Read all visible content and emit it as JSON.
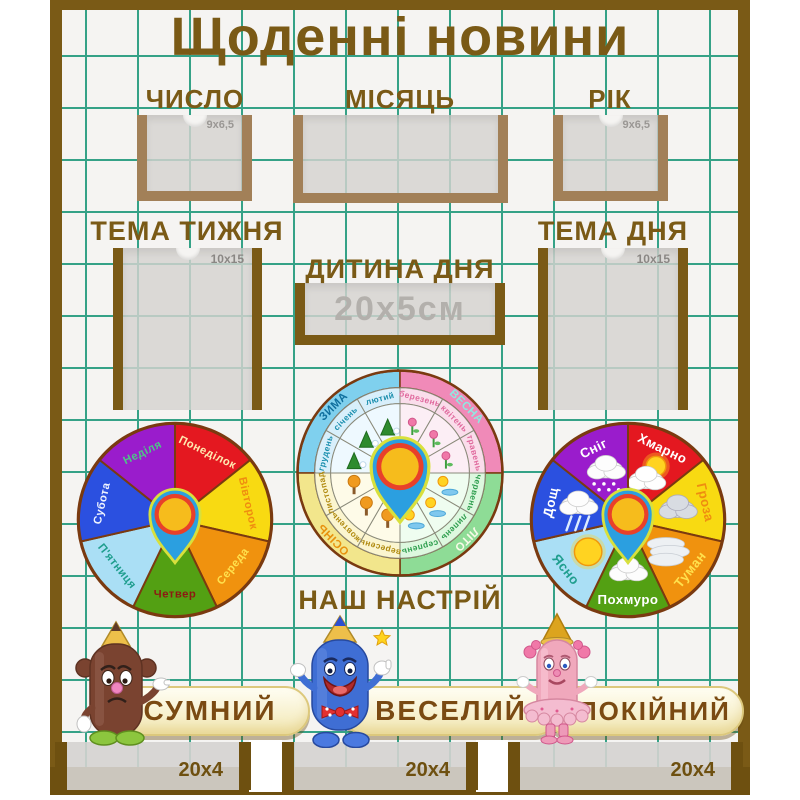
{
  "title": "Щоденні новини",
  "sections": {
    "date": {
      "label": "ЧИСЛО",
      "size": "9x6,5"
    },
    "month": {
      "label": "МІСЯЦЬ"
    },
    "year": {
      "label": "РІК",
      "size": "9x6,5"
    },
    "week_theme": {
      "label": "ТЕМА ТИЖНЯ",
      "size": "10x15"
    },
    "day_theme": {
      "label": "ТЕМА ДНЯ",
      "size": "10x15"
    },
    "child_of_day": {
      "label": "ДИТИНА ДНЯ",
      "size": "20х5см"
    },
    "mood_title": "НАШ НАСТРІЙ"
  },
  "moods": [
    {
      "name": "СУМНИЙ",
      "character": "sad-brown-pencil"
    },
    {
      "name": "ВЕСЕЛИЙ",
      "character": "happy-blue-pencil"
    },
    {
      "name": "СПОКІЙНИЙ",
      "character": "calm-pink-pencil"
    }
  ],
  "bottom_pockets": [
    {
      "size": "20x4"
    },
    {
      "size": "20x4"
    },
    {
      "size": "20x4"
    }
  ],
  "pin": {
    "body_color": "#2b9fe0",
    "ring_color": "#e8402a",
    "center_color": "#f6bc1c",
    "outline_color": "#d8e03c"
  },
  "colors": {
    "frame_brown": "#7a5a16",
    "pocket_frame_tan": "#a28058",
    "grid_line": "#35a287",
    "title_brown": "#7a5a16"
  },
  "day_wheel": {
    "segments": [
      {
        "label": "Понеділок",
        "color": "#e41820",
        "text_color": "#ffe9b0"
      },
      {
        "label": "Вівторок",
        "color": "#f8da12",
        "text_color": "#ef8d10"
      },
      {
        "label": "Середа",
        "color": "#f0920e",
        "text_color": "#ffe14d"
      },
      {
        "label": "Четвер",
        "color": "#53a013",
        "text_color": "#8c1a12"
      },
      {
        "label": "П'ятниця",
        "color": "#aadff5",
        "text_color": "#1f9e8e"
      },
      {
        "label": "Субота",
        "color": "#2b50e0",
        "text_color": "#eef3ff"
      },
      {
        "label": "Неділя",
        "color": "#9a1ccc",
        "text_color": "#4ec487"
      }
    ]
  },
  "weather_wheel": {
    "segments": [
      {
        "label": "Хмарно",
        "color": "#e41820",
        "text_color": "#ffffff",
        "icon": "sun-behind-cloud"
      },
      {
        "label": "Гроза",
        "color": "#f8da12",
        "text_color": "#ef8d10",
        "icon": "storm-cloud"
      },
      {
        "label": "Туман",
        "color": "#f0920e",
        "text_color": "#ffe14d",
        "icon": "fog"
      },
      {
        "label": "Похмуро",
        "color": "#53a013",
        "text_color": "#ffffff",
        "icon": "cloud"
      },
      {
        "label": "Ясно",
        "color": "#aadff5",
        "text_color": "#1f9e8e",
        "icon": "sun"
      },
      {
        "label": "Дощ",
        "color": "#2b50e0",
        "text_color": "#ffffff",
        "icon": "rain-cloud"
      },
      {
        "label": "Сніг",
        "color": "#9a1ccc",
        "text_color": "#ffffff",
        "icon": "snow-cloud"
      }
    ]
  },
  "month_wheel": {
    "seasons": [
      {
        "name": "ЗИМА",
        "start_angle": 270,
        "ring_color": "#7fd0ee",
        "band_color": "#d8effb",
        "fill_color": "#eef9ff",
        "text_color": "#0f6f9e",
        "month_text_color": "#1b8fae",
        "months": [
          "грудень",
          "січень",
          "лютий"
        ]
      },
      {
        "name": "ВЕСНА",
        "start_angle": 0,
        "ring_color": "#f08ab8",
        "band_color": "#faddeb",
        "fill_color": "#fceef5",
        "text_color": "#8fe8e0",
        "month_text_color": "#e06a9e",
        "months": [
          "березень",
          "квітень",
          "травень"
        ]
      },
      {
        "name": "ЛІТО",
        "start_angle": 90,
        "ring_color": "#8edc96",
        "band_color": "#ddf8df",
        "fill_color": "#effdf0",
        "text_color": "#f8fbe8",
        "month_text_color": "#2e9e4e",
        "months": [
          "червень",
          "липень",
          "серпень"
        ]
      },
      {
        "name": "ОСІНЬ",
        "start_angle": 180,
        "ring_color": "#f2e68c",
        "band_color": "#fbf5cf",
        "fill_color": "#fefbe8",
        "text_color": "#e8920e",
        "month_text_color": "#b08a10",
        "months": [
          "вересень",
          "жовтень",
          "листопад"
        ]
      }
    ]
  }
}
